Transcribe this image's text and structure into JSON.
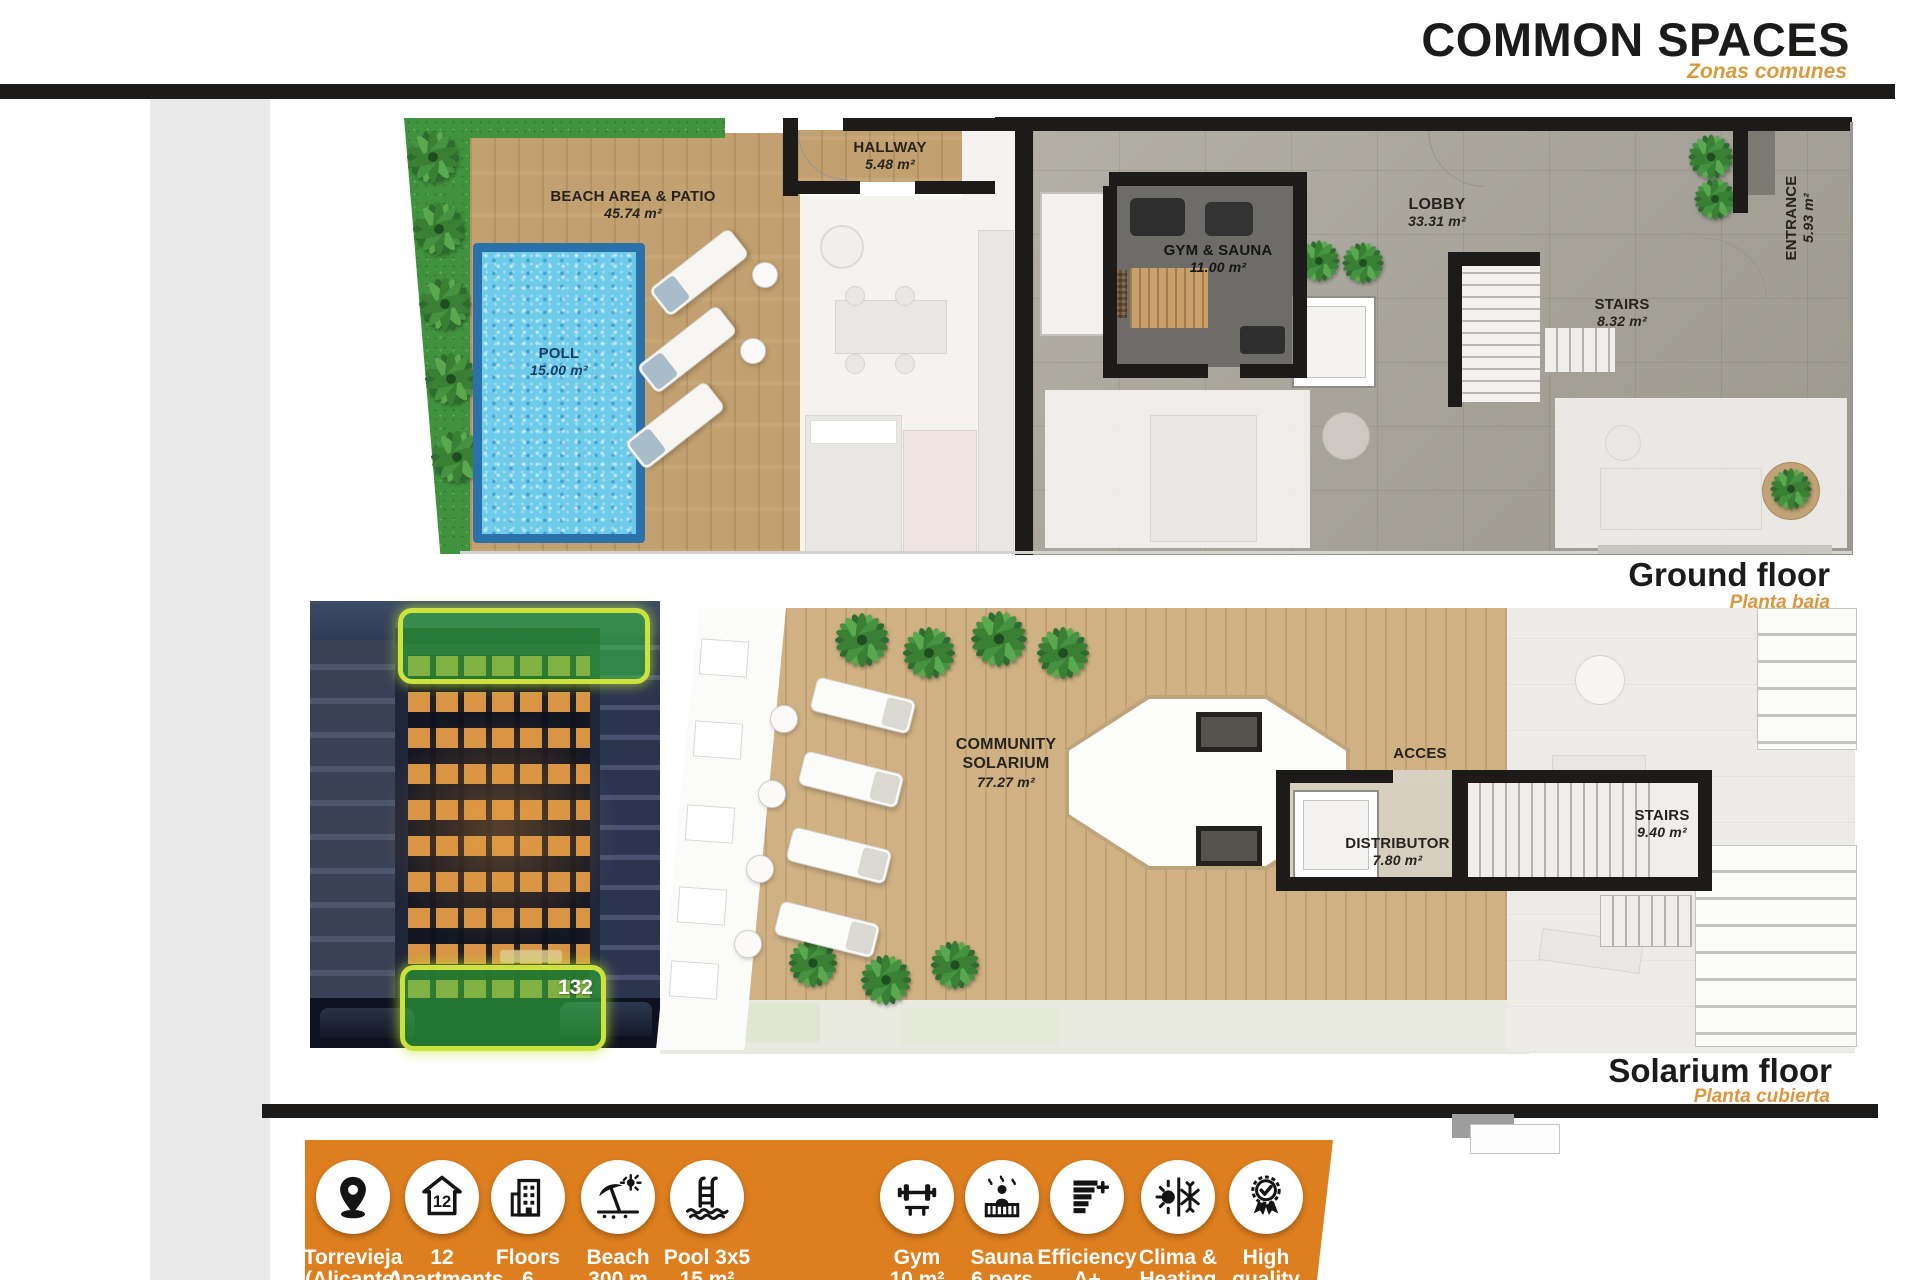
{
  "header": {
    "title": "COMMON SPACES",
    "subtitle": "Zonas comunes"
  },
  "ground_floor": {
    "caption": "Ground floor",
    "caption_es": "Planta baja",
    "rooms": {
      "beach_area": {
        "name": "BEACH AREA & PATIO",
        "area": "45.74 m²"
      },
      "hallway": {
        "name": "HALLWAY",
        "area": "5.48 m²"
      },
      "pool": {
        "name": "POLL",
        "area": "15.00 m²"
      },
      "gym_sauna": {
        "name": "GYM & SAUNA",
        "area": "11.00 m²"
      },
      "lobby": {
        "name": "LOBBY",
        "area": "33.31 m²"
      },
      "stairs": {
        "name": "STAIRS",
        "area": "8.32 m²"
      },
      "entrance": {
        "name": "ENTRANCE",
        "area": "5.93 m²"
      }
    }
  },
  "solarium_floor": {
    "caption": "Solarium floor",
    "caption_es": "Planta cubierta",
    "rooms": {
      "community_solarium": {
        "name": "COMMUNITY SOLARIUM",
        "area": "77.27 m²"
      },
      "access": {
        "name": "ACCES"
      },
      "distributor": {
        "name": "DISTRIBUTOR",
        "area": "7.80 m²"
      },
      "stairs": {
        "name": "STAIRS",
        "area": "9.40 m²"
      }
    }
  },
  "building_photo": {
    "unit_number": "132"
  },
  "banner": {
    "background_color": "#dd7e1f",
    "items": [
      {
        "icon": "location-pin-icon",
        "line1": "Torrevieja",
        "line2": "(Alicante)"
      },
      {
        "icon": "apartments-icon",
        "line1": "12",
        "line2": "Apartments"
      },
      {
        "icon": "floors-icon",
        "line1": "Floors",
        "line2": "6"
      },
      {
        "icon": "beach-icon",
        "line1": "Beach",
        "line2": "300 m"
      },
      {
        "icon": "pool-icon",
        "line1": "Pool 3x5",
        "line2": "15 m²"
      },
      {
        "icon": "gym-icon",
        "line1": "Gym",
        "line2": "10 m²"
      },
      {
        "icon": "sauna-icon",
        "line1": "Sauna",
        "line2": "6 pers"
      },
      {
        "icon": "efficiency-icon",
        "line1": "Efficiency",
        "line2": "A+"
      },
      {
        "icon": "clima-icon",
        "line1": "Clima &",
        "line2": "Heating"
      },
      {
        "icon": "quality-icon",
        "line1": "High",
        "line2": "quality"
      }
    ]
  },
  "colors": {
    "accent_orange": "#d79a3e",
    "banner_orange": "#dd7e1f"
  }
}
